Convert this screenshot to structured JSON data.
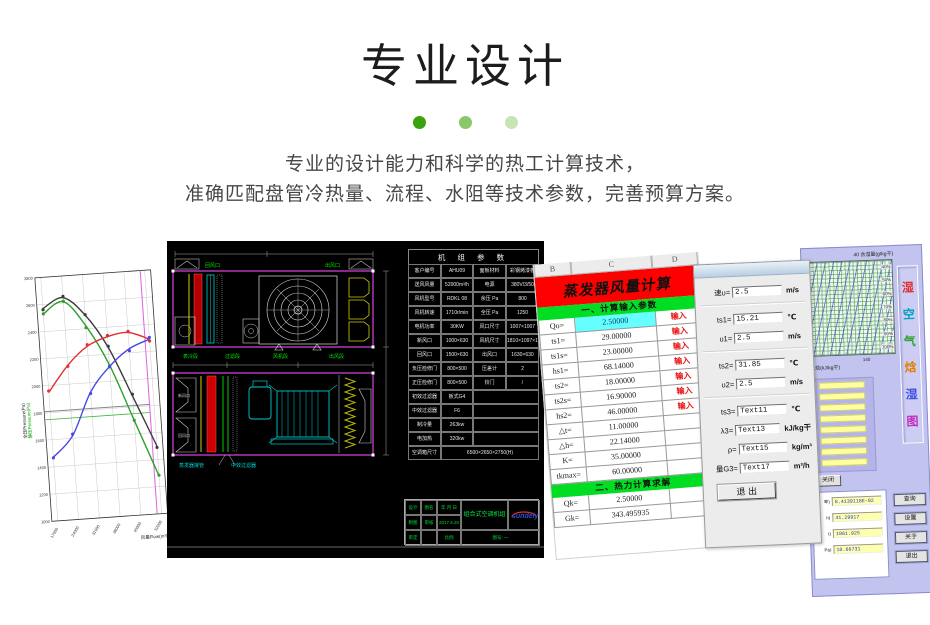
{
  "header": {
    "title": "专业设计",
    "desc1": "专业的设计能力和科学的热工计算技术，",
    "desc2": "准确匹配盘管冷热量、流程、水阻等技术参数，完善预算方案。",
    "dot_colors": [
      "#39a30d",
      "#8ac768",
      "#c6e4b4"
    ]
  },
  "chart_data": [
    {
      "type": "line",
      "title": "风机性能曲线",
      "xlabel": "风量Flow(m³/h)",
      "ylabels": [
        "全压Pressure(Pa)",
        "静压Pressure(Pa)"
      ],
      "x": [
        17000,
        24000,
        31000,
        38000,
        45000,
        52000
      ],
      "xlim": [
        15000,
        54000
      ],
      "ylim": [
        1000,
        2800
      ],
      "yticks": [
        1000,
        1200,
        1400,
        1600,
        1800,
        2000,
        2200,
        2400,
        2600,
        2800
      ],
      "grid": true,
      "legend_position": "none",
      "series": [
        {
          "name": "全压",
          "color": "#3c3c3c",
          "values": [
            2570,
            2640,
            2500,
            2250,
            1880,
            1500
          ]
        },
        {
          "name": "静压",
          "color": "#2ca02c",
          "values": [
            2530,
            2610,
            2420,
            2120,
            1700,
            1280
          ]
        },
        {
          "name": "功率",
          "color": "#e03030",
          "values": [
            1950,
            2140,
            2270,
            2330,
            2350,
            2290
          ]
        },
        {
          "name": "动压",
          "color": "#4848e0",
          "values": [
            1470,
            1620,
            1930,
            2110,
            2230,
            2290
          ]
        }
      ],
      "ref_lines": {
        "gray_pressure": 1810,
        "green_pressure": 1750,
        "flow_marker": 50500
      }
    },
    {
      "type": "area",
      "title": "湿空气焓湿图",
      "xlabel": "焓(kJ/kg干)",
      "ylabel": "含湿量(g/kg干)",
      "humidity_lines": [
        "40%",
        "50%",
        "60%",
        "70%",
        "80%",
        "90%",
        "100%"
      ]
    }
  ],
  "cad": {
    "table_title": "机 组 参 数",
    "table": [
      [
        "客户编号",
        "AHU09",
        "面板材料",
        "彩钢烤漆板"
      ],
      [
        "送风风量",
        "52000m³/h",
        "电源",
        "380V/3/50"
      ],
      [
        "风机型号",
        "RDKL 08",
        "余压 Pa",
        "800"
      ],
      [
        "风机转速",
        "1710r/min",
        "全压 Pa",
        "1250"
      ],
      [
        "电机功率",
        "30KW",
        "风口尺寸",
        "1007×1007"
      ],
      [
        "新风口",
        "1000×630",
        "风机尺寸",
        "1810×1097×1810"
      ],
      [
        "回风口",
        "1500×630",
        "出风口",
        "1630×630"
      ],
      [
        "负压检修门",
        "800×500",
        "压差计",
        "2"
      ],
      [
        "正压检修门",
        "800×500",
        "铰门",
        "/"
      ],
      [
        "初效过滤器",
        "板式G4",
        "",
        ""
      ],
      [
        "中效过滤器",
        "F6",
        "",
        ""
      ],
      [
        "制冷量",
        "263kw",
        "",
        ""
      ],
      [
        "电加热",
        "320kw",
        "",
        ""
      ],
      [
        "空调箱尺寸",
        "6500×2650×2750(H)",
        "",
        ""
      ]
    ],
    "top_labels": [
      "回风口",
      "出风口"
    ],
    "section_labels": [
      "表冷段",
      "过滤段",
      "风机段",
      "出风段"
    ],
    "lower_left_labels": [
      "新风口",
      "回风口"
    ],
    "bottom_labels": [
      "蒸发器接管",
      "中效过滤器"
    ],
    "titleblock": {
      "r1": [
        "设计",
        "图名",
        "年 月 日"
      ],
      "r2": [
        "制图",
        "审核",
        "2017.6.20"
      ],
      "r3": [
        "审定",
        "",
        "比例"
      ],
      "drawing_name": "组合式空调机组",
      "logo": "sundely",
      "sheet": "图号: 一"
    }
  },
  "excel": {
    "columns": [
      "B",
      "C",
      "D"
    ],
    "title": "蒸发器风量计算",
    "section1": "一、计算输入参数",
    "input_rows": [
      {
        "label": "Qo=",
        "value": "2.50000",
        "action": "输入",
        "highlight": true
      },
      {
        "label": "ts1=",
        "value": "29.00000",
        "action": "输入"
      },
      {
        "label": "ts1s=",
        "value": "23.00000",
        "action": "输入"
      },
      {
        "label": "hs1=",
        "value": "68.14000",
        "action": "输入"
      },
      {
        "label": "ts2=",
        "value": "18.00000",
        "action": "输入"
      },
      {
        "label": "ts2s=",
        "value": "16.90000",
        "action": "输入"
      },
      {
        "label": "hs2=",
        "value": "46.00000",
        "action": "输入"
      },
      {
        "label": "△t=",
        "value": "11.00000",
        "action": ""
      },
      {
        "label": "△h=",
        "value": "22.14000",
        "action": ""
      },
      {
        "label": "K=",
        "value": "35.00000",
        "action": ""
      },
      {
        "label": "tkmax=",
        "value": "60.00000",
        "action": ""
      }
    ],
    "section2": "二、热力计算求解",
    "result_rows": [
      {
        "label": "Qk=",
        "value": "2.50000"
      },
      {
        "label": "Gk=",
        "value": "343.495935"
      }
    ]
  },
  "dialog": {
    "fields": [
      {
        "label": "速υ=",
        "value": "2.5",
        "unit": "m/s"
      },
      {
        "label": "ts1=",
        "value": "15.21",
        "unit": "℃"
      },
      {
        "label": "υ1=",
        "value": "2.5",
        "unit": "m/s"
      },
      {
        "label": "ts2=",
        "value": "31.85",
        "unit": "℃"
      },
      {
        "label": "υ2=",
        "value": "2.5",
        "unit": "m/s"
      },
      {
        "label": "ts3=",
        "value": "Text11",
        "unit": "℃"
      },
      {
        "label": "λ3=",
        "value": "Text13",
        "unit": "kJ/kg干"
      },
      {
        "label": "ρ=",
        "value": "Text15",
        "unit": "kg/m³"
      },
      {
        "label": "量G3=",
        "value": "Text17",
        "unit": "m³/h"
      }
    ],
    "exit_label": "退 出"
  },
  "psychro": {
    "top_label": "40   含湿量(g/kg干)",
    "corner_label": "140",
    "bottom_label": "焓(kJ/kg干)",
    "vertical_title": "湿空气焓湿图",
    "vertical_title_colors": [
      "#e03030",
      "#00a0c0",
      "#30a030",
      "#e08000",
      "#4050e0",
      "#c030c0"
    ],
    "close_label": "关闭",
    "value_fields": [
      {
        "label": "率)",
        "value": "8.4139118E-02"
      },
      {
        "label": "h)",
        "value": "41.29917"
      },
      {
        "label": "t)",
        "value": "1061.925"
      },
      {
        "label": "Pa)",
        "value": "10.66731"
      }
    ],
    "buttons": [
      "查询",
      "设置",
      "关于",
      "退出"
    ]
  }
}
